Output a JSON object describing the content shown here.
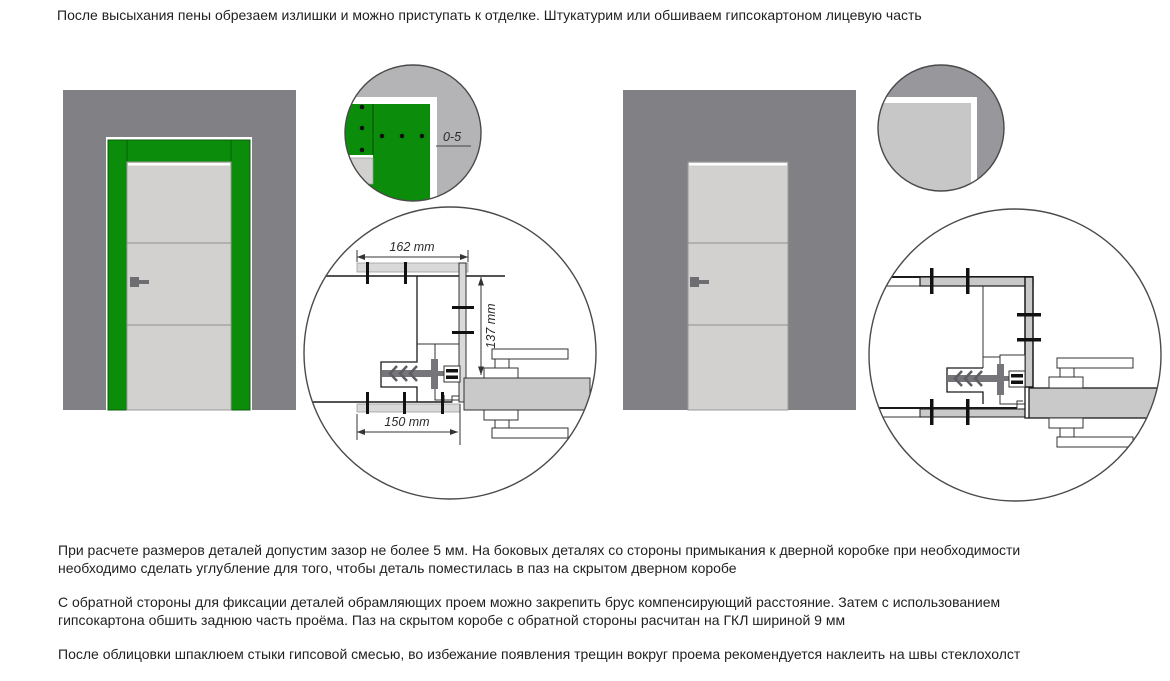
{
  "texts": {
    "intro": "После высыхания пены обрезаем излишки и можно приступать к отделке. Штукатурим или обшиваем гипсокартоном лицевую часть",
    "p1": "При расчете размеров деталей допустим зазор не более 5 мм. На боковых деталях со стороны примыкания к дверной коробке при необходимости необходимо сделать углубление для того, чтобы деталь поместилась в паз на скрытом дверном коробе",
    "p2": "С обратной стороны для фиксации деталей обрамляющих проем можно закрепить брус компенсирующий расстояние. Затем с использованием гипсокартона обшить заднюю часть проёма. Паз на скрытом коробе с обратной стороны расчитан на ГКЛ шириной 9 мм",
    "p3": "После облицовки шпаклюем стыки гипсовой смесью, во избежание появления трещин вокруг проема рекомендуется наклеить на швы стеклохолст"
  },
  "dimensions": {
    "gap": "0-5",
    "top_width": "162 mm",
    "side_height": "137 mm",
    "bottom_width": "150 mm"
  },
  "colors": {
    "wall": "#818185",
    "casing_green": "#0b8c0b",
    "casing_seam": "#056105",
    "door_leaf": "#d3d1cf",
    "detail_bg": "#b4b4b6",
    "corner_wall": "#98989c",
    "corner_finish": "#c7c7c7",
    "strip_gray": "#d9d9d9",
    "finish_gray": "#c9c9c9",
    "hardware_gray": "#75757a",
    "handle_gray": "#6e6e72"
  }
}
